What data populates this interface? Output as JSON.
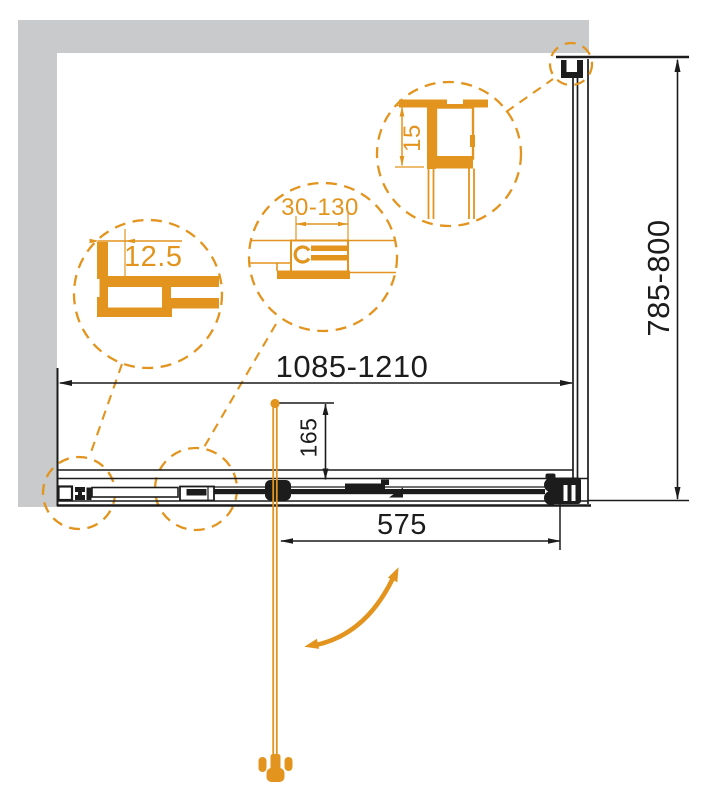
{
  "drawing": {
    "type": "shower-enclosure-plan-technical-drawing",
    "dimensions": {
      "width_range": "1085-1210",
      "depth_range": "785-800",
      "door_opening": "575",
      "handle_offset": "165"
    },
    "details": {
      "wall_profile_offset": "12.5",
      "adjustment_range": "30-130",
      "top_profile_size": "15"
    },
    "colors": {
      "accent_orange": "#E2941E",
      "wall_gray": "#C9CACB",
      "line_black": "#1C1C1C"
    }
  }
}
